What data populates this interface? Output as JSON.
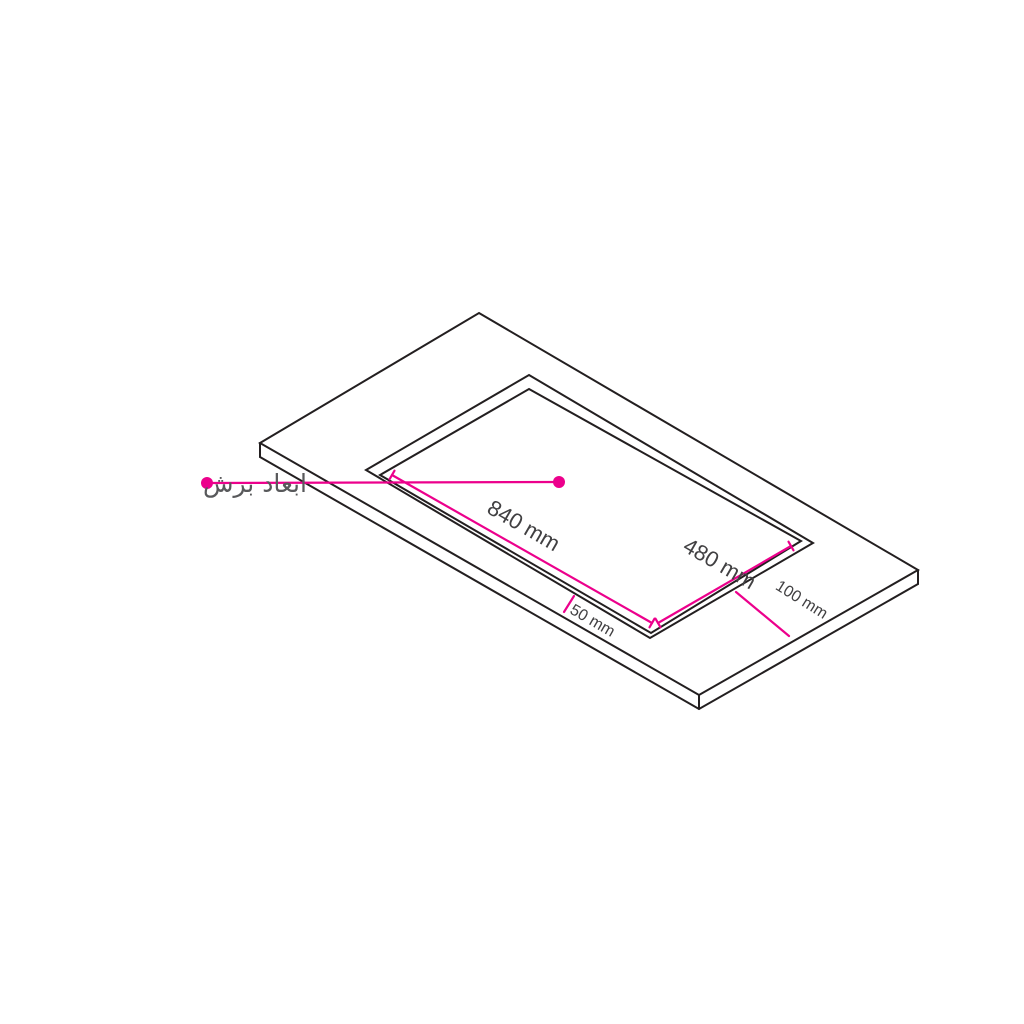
{
  "title": "countertop-cutout-dimension-diagram",
  "colors": {
    "accent": "#ec008c",
    "outline": "#231f20",
    "callout_text": "#58595b",
    "dimension_text": "#414042",
    "background": "#ffffff"
  },
  "callout": {
    "label": "ابعاد برش"
  },
  "dimensions": {
    "cutout_length": "840 mm",
    "cutout_width": "480 mm",
    "front_offset": "50 mm",
    "side_offset": "100 mm"
  }
}
